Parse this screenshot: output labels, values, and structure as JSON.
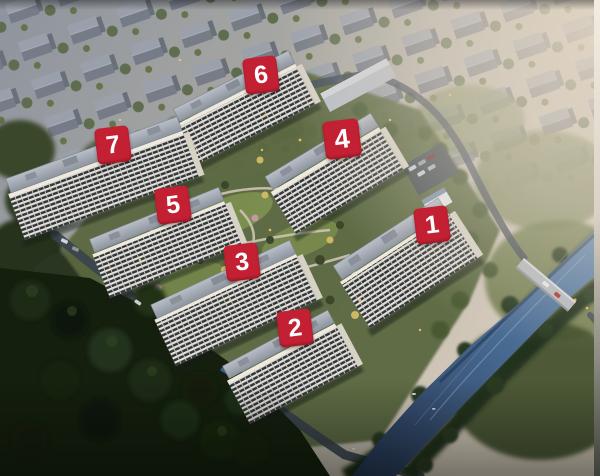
{
  "image": {
    "type": "aerial-rendering",
    "subject": "residential complex site plan with seven numbered buildings, villa district, central landscaped courtyard, perimeter roads, river and bridge",
    "building_markers": [
      {
        "label": "1"
      },
      {
        "label": "2"
      },
      {
        "label": "3"
      },
      {
        "label": "4"
      },
      {
        "label": "5"
      },
      {
        "label": "6"
      },
      {
        "label": "7"
      }
    ],
    "colors": {
      "marker_background": "#c32133",
      "marker_text": "#ffffff",
      "river": "#47688f",
      "forest_dark": "#141f0e",
      "building_facade": "#eae5da",
      "building_roof": "#9aa2ac",
      "haze": "#ded3c4"
    }
  }
}
